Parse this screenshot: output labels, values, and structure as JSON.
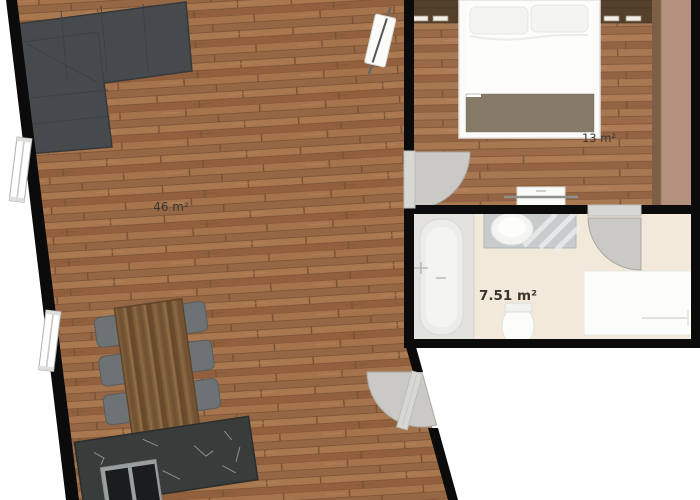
{
  "title": "Apartment floor plan",
  "rooms": {
    "living_room": {
      "area_label": "46 m²",
      "floor": "wood"
    },
    "bedroom": {
      "area_label": "13 m²",
      "floor": "wood"
    },
    "bathroom": {
      "area_label": "7.51 m²",
      "floor": "cream tile"
    }
  },
  "furniture": {
    "living_room": [
      "corner-sofa",
      "dining-table",
      "dining-chairs-x6",
      "kitchen-counter",
      "cooktop",
      "radiator"
    ],
    "bedroom": [
      "double-bed",
      "pillows",
      "blanket",
      "headboard-cabinet-left",
      "headboard-cabinet-right",
      "wardrobe",
      "tv-sideboard"
    ],
    "bathroom": [
      "bathtub",
      "washbasin-vanity",
      "toilet",
      "white-cabinet"
    ]
  },
  "openings": {
    "windows_on_left_wall": 2,
    "doors": [
      "entry-door",
      "bedroom-door",
      "bathroom-door"
    ]
  },
  "colors": {
    "wall": "#0b0b0b",
    "outside": "#ffffff",
    "sofa": "#474a4c",
    "sofa_edge": "#36383a",
    "chair": "#6d7275",
    "table_edge": "#5e4527",
    "counter_marble": "#383c3b",
    "cooktop": "#1b1c1e",
    "bed": "#fbfbfa",
    "blanket": "#847a67",
    "headboard_wood": "#54402b",
    "wardrobe_band": "#b4917e",
    "wardrobe_strip": "#7d5f45",
    "bathroom_floor": "#f3e9da",
    "tub_platform": "#e3e2de",
    "fixture_white": "#fcfcfa",
    "vanity_counter": "#c7cbcc",
    "door_disc": "#cac9c6",
    "door_leaf": "#d7d7d4",
    "window_white": "#ffffff",
    "wood_base": "#9c6c48"
  }
}
